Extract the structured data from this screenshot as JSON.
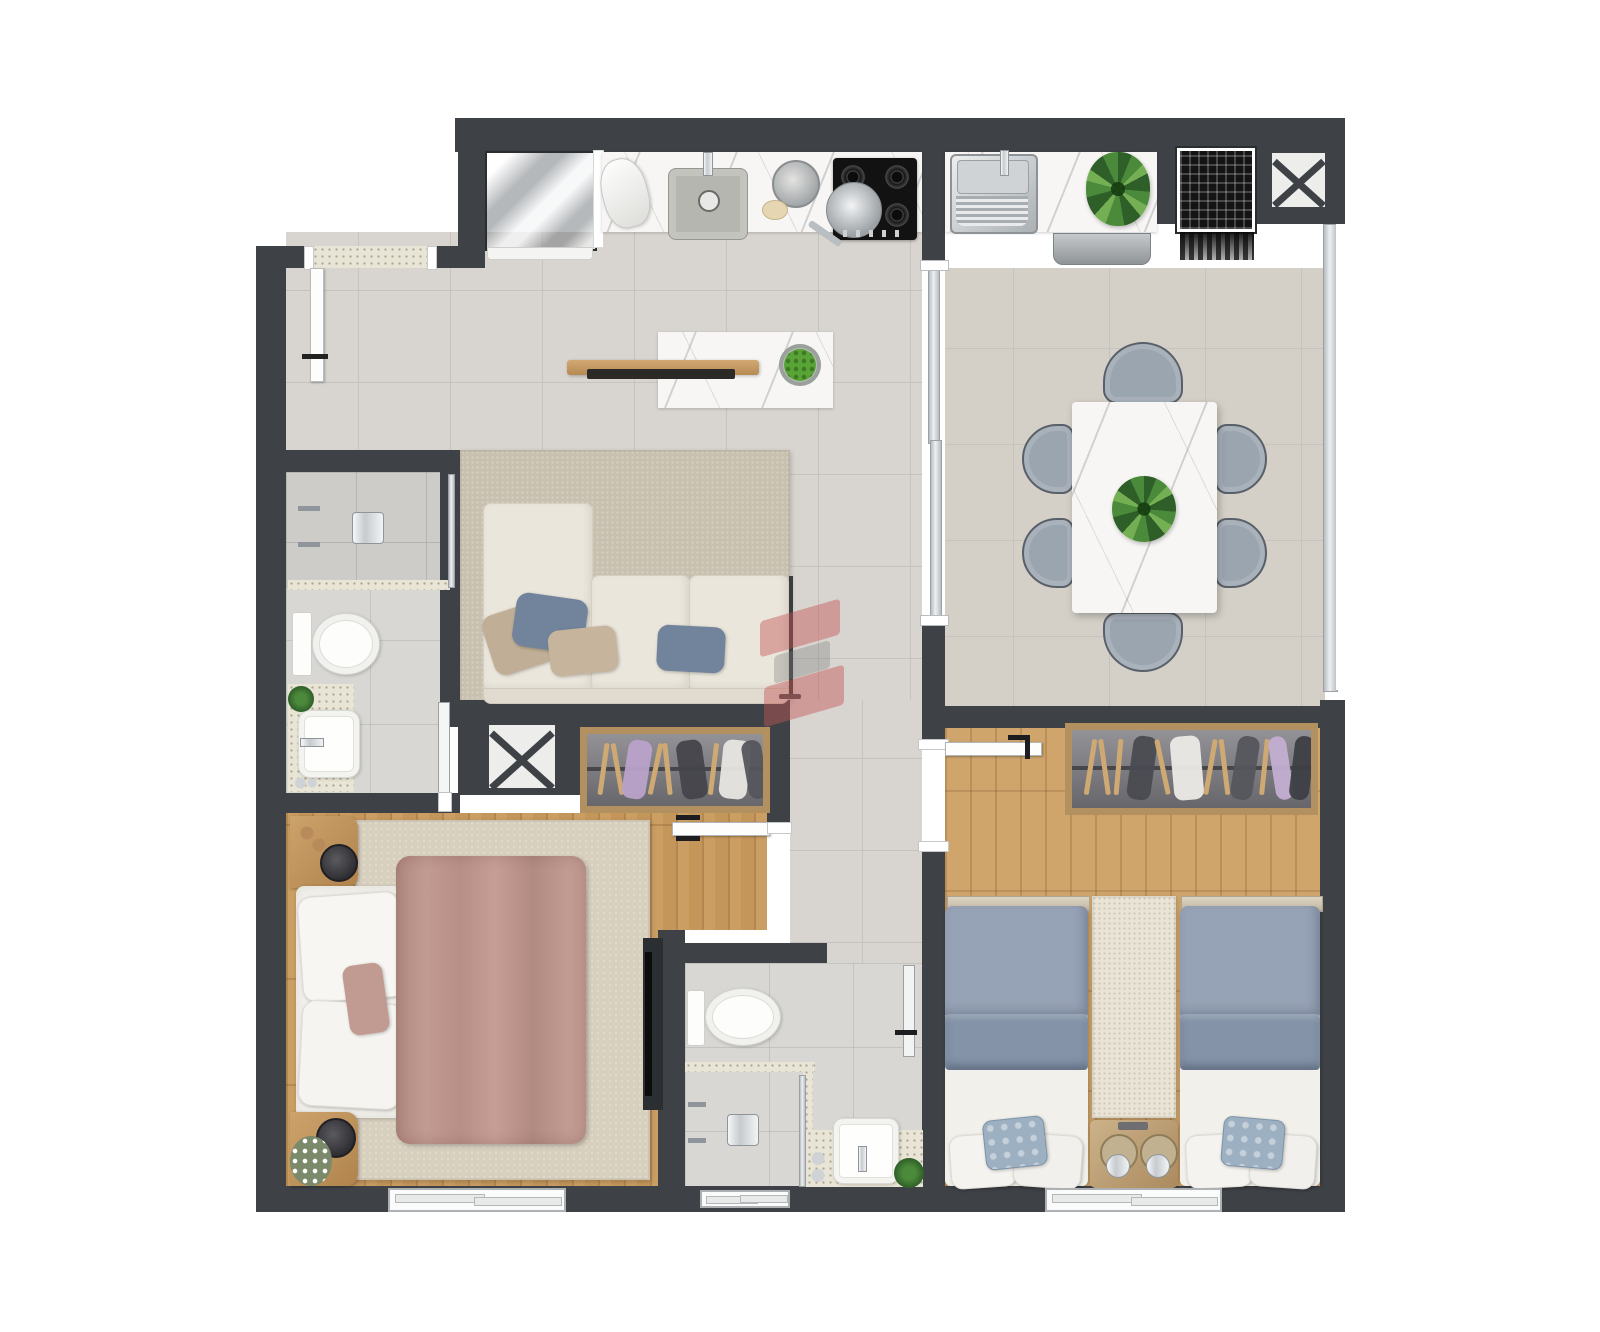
{
  "canvas": {
    "width": 1600,
    "height": 1332
  },
  "palette": {
    "white": "#ffffff",
    "wall": "#3e4246",
    "wallDeep": "#35393c",
    "tileLiving": "#d8d4cf",
    "tileGrout": "#c6c2bd",
    "tileDining": "#d4d0c8",
    "tileBath": "#d8d7d4",
    "tileShower": "#cdccc9",
    "speckle": "#e9e5d6",
    "marble": "#f7f6f4",
    "wood": "#c5965a",
    "woodLight": "#cfa56c",
    "frameWood": "#b2905f",
    "rugMaster": "#d8d0bf",
    "rugTwin": "#eae4d6",
    "rugLiving": "#c9c1b0",
    "sofa": "#eae6dc",
    "pillowBlue": "#72849c",
    "pillowTan": "#c0af96",
    "duvetRose": "#c19a91",
    "duvetRoseDark": "#b18a81",
    "duvetTwin": "#96a2b5",
    "duvetTwinDark": "#8493a8",
    "mattress": "#f2f0ea",
    "chair": "#9ba5b0",
    "chairEdge": "#596069",
    "closet": "#7b7a7f",
    "steelA": "#f0f1f2",
    "steelB": "#9ea3a7",
    "chrome": "#d8dcde",
    "chromeEdge": "#8f959a",
    "leaf": "#4c8a3b",
    "leafDark": "#2f5f28",
    "leafLight": "#74b053",
    "watermark": "rgba(196,85,85,0.5)"
  },
  "watermark": {
    "shape": "s-ribbon-logo",
    "color": "#c45555",
    "opacity": 0.5
  },
  "plan": {
    "type": "apartment-floor-plan-top-view",
    "rooms": [
      {
        "id": "kitchen",
        "furniture": [
          "refrigerator",
          "marble-countertop",
          "stand-mixer",
          "kitchen-sink",
          "pot",
          "fruit-bowl-small",
          "gas-cooktop",
          "frying-pan"
        ]
      },
      {
        "id": "laundry",
        "furniture": [
          "laundry-tub",
          "plant",
          "washing-machine"
        ]
      },
      {
        "id": "living-room",
        "furniture": [
          "island-counter",
          "wood-shelf",
          "serving-tray",
          "fruit-bowl",
          "area-rug",
          "sofa",
          "throw-pillows",
          "floor-lamp"
        ]
      },
      {
        "id": "dining-room",
        "furniture": [
          "marble-dining-table",
          "dining-chairs-x6",
          "centerpiece-plant",
          "sliding-glass-partition",
          "full-height-window"
        ]
      },
      {
        "id": "bathroom-1",
        "furniture": [
          "shower-area",
          "shower-head",
          "shower-valves",
          "glass-screen",
          "toilet",
          "vanity-counter",
          "vessel-sink",
          "small-plant",
          "door"
        ]
      },
      {
        "id": "master-bedroom",
        "furniture": [
          "double-bed",
          "rose-duvet",
          "pillows",
          "nightstand-x2",
          "flower-vase",
          "area-rug",
          "wardrobe-with-hangers",
          "tv-panel",
          "window",
          "door"
        ]
      },
      {
        "id": "bathroom-2",
        "furniture": [
          "shower-area",
          "shower-head",
          "glass-screen",
          "toilet",
          "vanity-counter",
          "vessel-sink",
          "small-plant",
          "window",
          "door"
        ]
      },
      {
        "id": "twin-bedroom",
        "furniture": [
          "single-bed-x2",
          "blue-duvets",
          "patterned-pillows",
          "shared-nightstand",
          "table-lamp-x2",
          "runner-rug",
          "wardrobe-with-hangers",
          "window",
          "door"
        ]
      },
      {
        "id": "service-shafts",
        "furniture": [
          "x-shaft-near-entry-hall",
          "x-shaft-top-right",
          "ac-vent-grate"
        ]
      }
    ]
  }
}
